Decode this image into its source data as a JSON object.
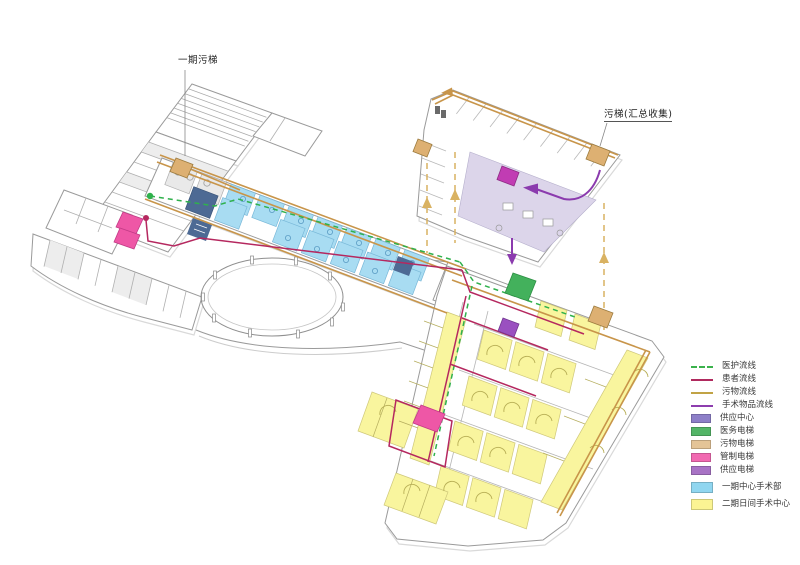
{
  "annotations": {
    "phase1_waste_elevator_label": "一期污梯",
    "collect_waste_elevator_label": "污梯(汇总收集)"
  },
  "legend": {
    "items": [
      {
        "id": "staff-flow",
        "label": "医护流线",
        "swatch": "dashed-line",
        "color": "#3bb24c"
      },
      {
        "id": "patient-flow",
        "label": "患者流线",
        "swatch": "line",
        "color": "#b02a5e"
      },
      {
        "id": "waste-flow",
        "label": "污物流线",
        "swatch": "line",
        "color": "#c1a345"
      },
      {
        "id": "surgical-goods-flow",
        "label": "手术物品流线",
        "swatch": "line",
        "color": "#8d3dae"
      },
      {
        "id": "supply-center",
        "label": "供应中心",
        "swatch": "box",
        "color": "#8d7fc8"
      },
      {
        "id": "medical-elevator",
        "label": "医务电梯",
        "swatch": "box",
        "color": "#53b567"
      },
      {
        "id": "waste-elevator",
        "label": "污物电梯",
        "swatch": "box",
        "color": "#e4c497"
      },
      {
        "id": "control-elevator",
        "label": "管制电梯",
        "swatch": "box",
        "color": "#f169b1"
      },
      {
        "id": "supply-elevator",
        "label": "供应电梯",
        "swatch": "box",
        "color": "#a873c5"
      },
      {
        "id": "phase1-or-center",
        "label": "一期中心手术部",
        "swatch": "box",
        "color": "#90d6f0",
        "gap": true
      },
      {
        "id": "phase2-day-surgery",
        "label": "二期日间手术中心",
        "swatch": "box",
        "color": "#fbf493",
        "gap": true
      }
    ]
  }
}
